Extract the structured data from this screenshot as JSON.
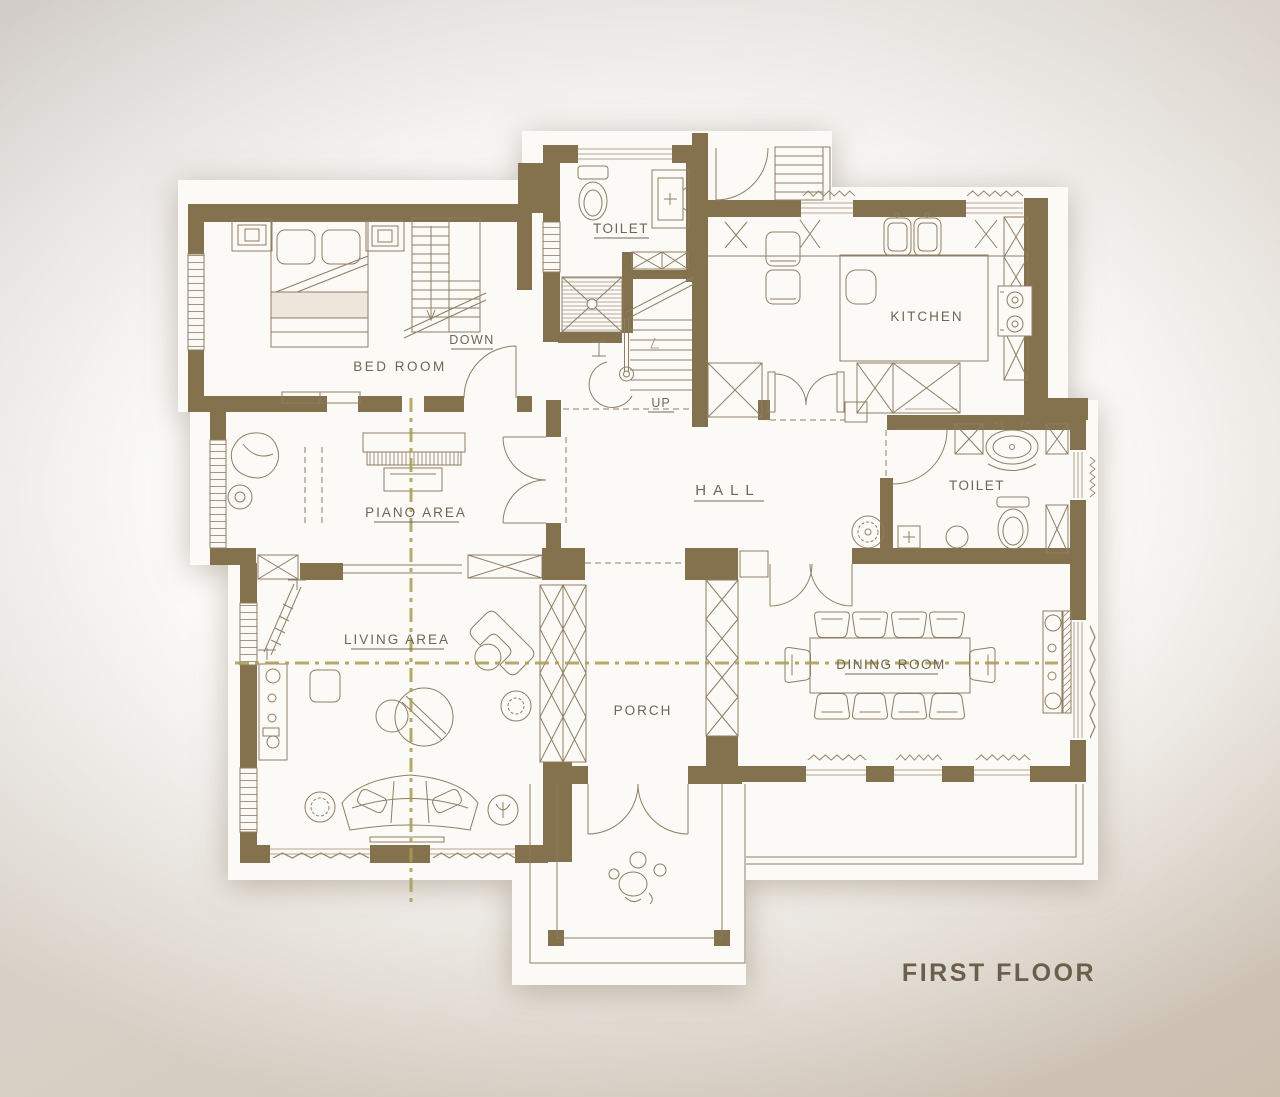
{
  "title": "FIRST FLOOR",
  "rooms": {
    "bed_room": "BED ROOM",
    "toilet_top": "TOILET",
    "kitchen": "KITCHEN",
    "hall": "HALL",
    "toilet_right": "TOILET",
    "piano_area": "PIANO AREA",
    "living_area": "LIVING AREA",
    "porch": "PORCH",
    "dining_room": "DINING ROOM"
  },
  "stairs": {
    "down_label": "DOWN",
    "up_label": "UP"
  },
  "colors": {
    "wall": "#84714E",
    "drawing_line": "#8E7E63",
    "centerline": "#A89C4F",
    "label_text": "#6F6555",
    "title_text": "#6B5F4C",
    "paper": "#FCFAF7"
  }
}
